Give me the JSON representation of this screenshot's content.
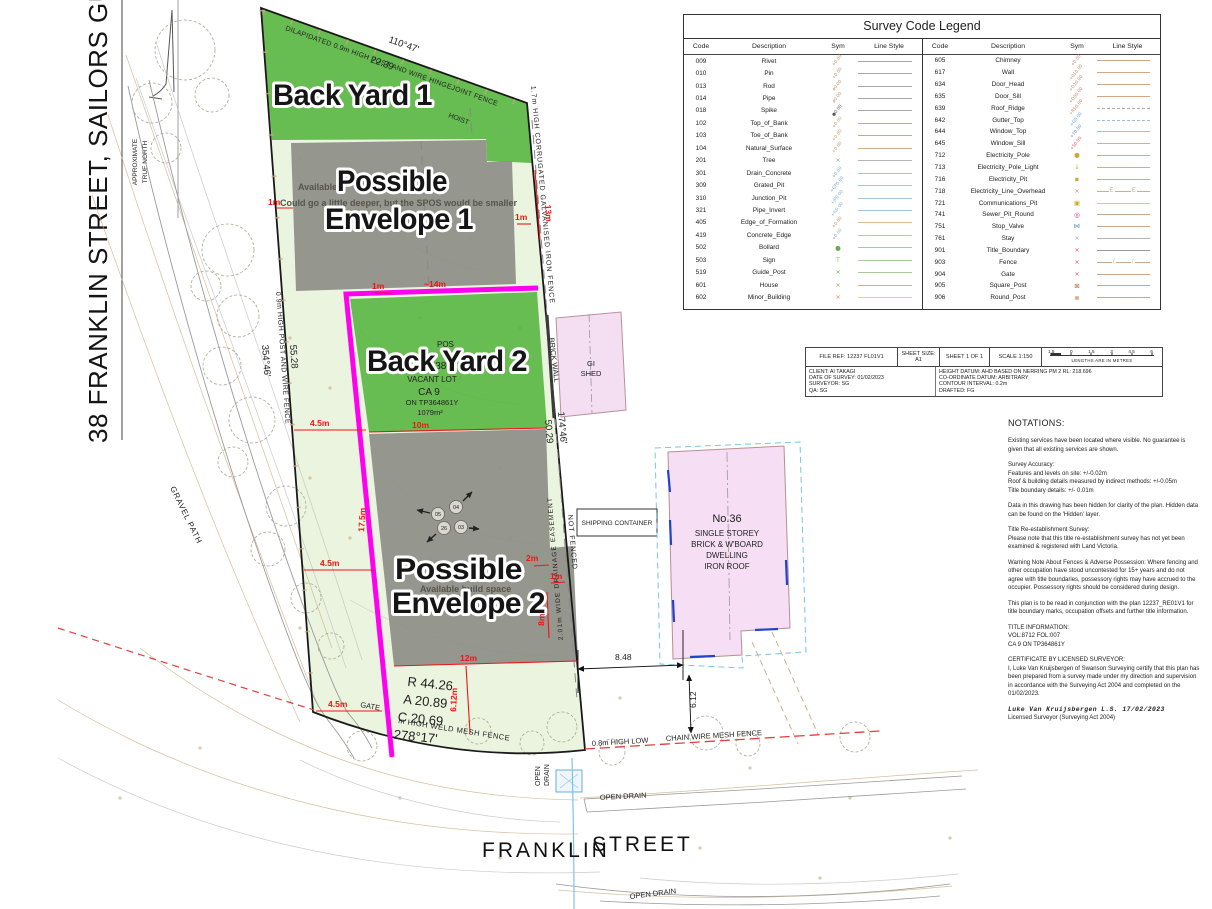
{
  "page": {
    "title_vertical": "38 FRANKLIN STREET, SAILORS GULLY, 3556",
    "north_line1": "APPROXIMATE",
    "north_line2": "TRUE NORTH"
  },
  "legend": {
    "title": "Survey Code Legend",
    "headers": [
      "Code",
      "Description",
      "Sym",
      "Line Style"
    ],
    "left": [
      {
        "c": "009",
        "d": "Rivet",
        "s": "+0.00",
        "sc": "#b89070",
        "lc": "#a8a8a8",
        "ls": "solid"
      },
      {
        "c": "010",
        "d": "Pin",
        "s": "+0.00",
        "sc": "#b89070",
        "lc": "#a8a8a8",
        "ls": "solid"
      },
      {
        "c": "013",
        "d": "Rod",
        "s": "ø0.00",
        "sc": "#b89070",
        "lc": "#a8a8a8",
        "ls": "solid"
      },
      {
        "c": "014",
        "d": "Pipe",
        "s": "ø0.00",
        "sc": "#b89070",
        "lc": "#a8a8a8",
        "ls": "solid"
      },
      {
        "c": "018",
        "d": "Spike",
        "s": "●0.00",
        "sc": "#555555",
        "lc": "#a8a8a8",
        "ls": "solid"
      },
      {
        "c": "102",
        "d": "Top_of_Bank",
        "s": "+0.00",
        "sc": "#c49a6c",
        "lc": "#c8a87c",
        "ls": "solid"
      },
      {
        "c": "103",
        "d": "Toe_of_Bank",
        "s": "+0.00",
        "sc": "#c49a6c",
        "lc": "#c8a87c",
        "ls": "solid"
      },
      {
        "c": "104",
        "d": "Natural_Surface",
        "s": "+0.00",
        "sc": "#c49a6c",
        "lc": "#d8b088",
        "ls": "solid"
      },
      {
        "c": "201",
        "d": "Tree",
        "s": "×",
        "sc": "#9aa87a",
        "lc": "#b4b4b4",
        "ls": "solid"
      },
      {
        "c": "301",
        "d": "Drain_Concrete",
        "s": "+0.00",
        "sc": "#7aa8cc",
        "lc": "#a4c4dc",
        "ls": "solid"
      },
      {
        "c": "309",
        "d": "Grated_Pit",
        "s": "+GP0.00",
        "sc": "#7aa8cc",
        "lc": "#a4c4dc",
        "ls": "solid"
      },
      {
        "c": "310",
        "d": "Junction_Pit",
        "s": "+JP0.00",
        "sc": "#7aa8cc",
        "lc": "#a4c4dc",
        "ls": "solid"
      },
      {
        "c": "321",
        "d": "Pipe_Invert",
        "s": "+IL0.00",
        "sc": "#7aa8cc",
        "lc": "#a4c4dc",
        "ls": "solid"
      },
      {
        "c": "405",
        "d": "Edge_of_Formation",
        "s": "+0.00",
        "sc": "#c89058",
        "lc": "#e0bc90",
        "ls": "solid"
      },
      {
        "c": "419",
        "d": "Concrete_Edge",
        "s": "+0.00",
        "sc": "#90a8c0",
        "lc": "#b4c4d4",
        "ls": "solid"
      },
      {
        "c": "502",
        "d": "Bollard",
        "s": "●",
        "sc": "#6aaa50",
        "lc": "#a8c8a0",
        "ls": "solid"
      },
      {
        "c": "503",
        "d": "Sign",
        "s": "⊤",
        "sc": "#6aaa50",
        "lc": "#a8c8a0",
        "ls": "solid"
      },
      {
        "c": "519",
        "d": "Guide_Post",
        "s": "×",
        "sc": "#6aaa50",
        "lc": "#a8c8a0",
        "ls": "solid"
      },
      {
        "c": "601",
        "d": "House",
        "s": "×",
        "sc": "#cc8866",
        "lc": "#d8ac94",
        "ls": "solid"
      },
      {
        "c": "602",
        "d": "Minor_Building",
        "s": "×",
        "sc": "#cc8866",
        "lc": "#e4c8a0",
        "ls": "solid"
      }
    ],
    "right": [
      {
        "c": "605",
        "d": "Chimney",
        "s": "+0.00",
        "sc": "#c08868",
        "lc": "#d0a888",
        "ls": "solid"
      },
      {
        "c": "617",
        "d": "Wall",
        "s": "+010.00",
        "sc": "#c08868",
        "lc": "#d0a888",
        "ls": "solid"
      },
      {
        "c": "634",
        "d": "Door_Head",
        "s": "+D10.00",
        "sc": "#c08868",
        "lc": "#d0a888",
        "ls": "solid"
      },
      {
        "c": "635",
        "d": "Door_Sill",
        "s": "+D50.00",
        "sc": "#c08868",
        "lc": "#d0a888",
        "ls": "solid"
      },
      {
        "c": "639",
        "d": "Roof_Ridge",
        "s": "+R50.00",
        "sc": "#c08868",
        "lc": "#a8a8a8",
        "ls": "dashed"
      },
      {
        "c": "642",
        "d": "Gutter_Top",
        "s": "+G0.00",
        "sc": "#68a0d0",
        "lc": "#9cc0dc",
        "ls": "dashed"
      },
      {
        "c": "644",
        "d": "Window_Top",
        "s": "+T0.00",
        "sc": "#5890d0",
        "lc": "#9cc0dc",
        "ls": "solid"
      },
      {
        "c": "645",
        "d": "Window_Sill",
        "s": "+S0.00",
        "sc": "#e06060",
        "lc": "#dca8a0",
        "ls": "solid"
      },
      {
        "c": "712",
        "d": "Electricity_Pole",
        "s": "●",
        "sc": "#d0a830",
        "lc": "#c8b088",
        "ls": "solid"
      },
      {
        "c": "713",
        "d": "Electricity_Pole_Light",
        "s": "↓",
        "sc": "#d0a830",
        "lc": "#c8b088",
        "ls": "solid"
      },
      {
        "c": "716",
        "d": "Electricity_Pit",
        "s": "▪",
        "sc": "#d0a830",
        "lc": "#c8b088",
        "ls": "solid"
      },
      {
        "c": "718",
        "d": "Electricity_Line_Overhead",
        "s": "×",
        "sc": "#c09060",
        "lc": "#c8b088",
        "ls": "overhead"
      },
      {
        "c": "721",
        "d": "Communications_Pit",
        "s": "▣",
        "sc": "#d0a830",
        "lc": "#e0c878",
        "ls": "solid"
      },
      {
        "c": "741",
        "d": "Sewer_Pit_Round",
        "s": "◎",
        "sc": "#e0218a",
        "lc": "#c4a890",
        "ls": "solid"
      },
      {
        "c": "751",
        "d": "Stop_Valve",
        "s": "⋈",
        "sc": "#5890d0",
        "lc": "#c4a890",
        "ls": "solid"
      },
      {
        "c": "761",
        "d": "Stay",
        "s": "×",
        "sc": "#aaaaaa",
        "lc": "#b4b4b4",
        "ls": "solid"
      },
      {
        "c": "901",
        "d": "Title_Boundary",
        "s": "×",
        "sc": "#e05050",
        "lc": "#989898",
        "ls": "solid"
      },
      {
        "c": "903",
        "d": "Fence",
        "s": "×",
        "sc": "#e05050",
        "lc": "#c4a890",
        "ls": "fence"
      },
      {
        "c": "904",
        "d": "Gate",
        "s": "×",
        "sc": "#e05050",
        "lc": "#c4a890",
        "ls": "solid"
      },
      {
        "c": "905",
        "d": "Square_Post",
        "s": "⊠",
        "sc": "#b07848",
        "lc": "#c4a890",
        "ls": "solid"
      },
      {
        "c": "906",
        "d": "Round_Post",
        "s": "⊗",
        "sc": "#b07848",
        "lc": "#c4a890",
        "ls": "solid"
      }
    ]
  },
  "title_block": {
    "file_ref": "FILE REF:  12237 FL01V1",
    "sheet_size": "SHEET SIZE:\nA1",
    "sheet": "SHEET 1 OF 1",
    "scale": "SCALE    1:150",
    "scalebar_ticks": [
      "1.5",
      "0",
      "1.5",
      "3",
      "4.5",
      "6"
    ],
    "scalebar_note": "LENGTHS ARE IN METRES",
    "client": "CLIENT: AI TAKAGI",
    "date_of_survey": "DATE OF SURVEY: 01/02/2023",
    "surveyor": "SURVEYOR: SG",
    "qa": "QA: SG",
    "height_datum": "HEIGHT DATUM: AHD BASED ON NERRING PM 2 RL: 218.696",
    "coordinate_datum": "CO-ORDINATE DATUM: ARBITRARY",
    "contour_interval": "CONTOUR INTERVAL: 0.2m",
    "drafted": "DRAFTED: FG"
  },
  "notations": {
    "heading": "NOTATIONS:",
    "paragraphs": [
      "Existing services have been located where visible. No guarantee is given that all existing services are shown.",
      "Survey Accuracy:\nFeatures and levels on site: +/-0.02m\nRoof & building details measured by indirect methods: +/-0.05m\nTitle boundary details: +/- 0.01m",
      "Data in this drawing has been hidden for clarity of the plan. Hidden data can be found on the 'Hidden' layer.",
      "Title Re-establishment Survey:\nPlease note that this title re-establishment survey has not yet been examined & registered with Land Victoria.",
      "Warning Note About Fences & Adverse Possession: Where fencing and other occupation have stood uncontested for 15+ years and do not agree with title boundaries, possessory rights may have accrued to the occupier. Possessory rights should be considered during design.",
      "This plan is to be read in conjunction with the plan 12237_RE01V1 for title boundary marks, occupation offsets and further title information.",
      "TITLE INFORMATION:\nVOL:8712 FOL:007\nCA 9 ON TP364861Y",
      "CERTIFICATE BY LICENSED SURVEYOR:\nI, Luke Van Kruijsbergen  of Swanson Surveying certify that this plan has been prepared from a survey made under my direction and supervision in accordance with the Surveying Act 2004 and completed on the 01/02/2023."
    ],
    "signature": "Luke Van Kruijsbergen   L.S.  17/02/2023",
    "signature_sub": "Licensed Surveyor (Surveying Act 2004)"
  },
  "plan": {
    "labels": {
      "back_yard_1": "Back Yard 1",
      "back_yard_2": "Back Yard 2",
      "possible": "Possible",
      "envelope_1": "Envelope 1",
      "envelope_2": "Envelope 2",
      "available": "Available",
      "spos_note": "Could go a little deeper, but the SPOS would be smaller",
      "available_build": "Available build space",
      "pos": "POS",
      "no38": "No.38",
      "vacant_lot": "VACANT LOT",
      "ca9": "CA 9",
      "tp": "ON TP364861Y",
      "area": "1079m²",
      "fence_top": "DILAPIDATED 0.9m HIGH POST AND WIRE HINGEJOINT FENCE",
      "bearing_top": "110°47'",
      "dist_top": "22.39",
      "hoist": "HOIST",
      "fence_right": "1.7m HIGH CORRUGATED GALVANISED IRON FENCE",
      "fence_left": "0.9m HIGH POST AND WIRE FENCE",
      "bearing_left": "354°46'",
      "dist_left": "55.28",
      "gravel_path": "GRAVEL PATH",
      "bearing_right": "174°46'",
      "dist_right": "50.29",
      "brick_wall": "BRICK WALL",
      "easement": "2.01m WIDE DRAINAGE EASEMENT",
      "not_fenced": "NOT FENCED",
      "gi": "GI",
      "shed": "SHED",
      "shipping_container": "SHIPPING CONTAINER",
      "no36": "No.36",
      "no36_2": "SINGLE STOREY",
      "no36_3": "BRICK & W'BOARD",
      "no36_4": "DWELLING",
      "no36_5": "IRON ROOF",
      "gate": "GATE",
      "weld_fence": "m HIGH WELD MESH FENCE",
      "chain_fence_1": "0.8m HIGH LOW",
      "chain_fence_2": "CHAIN WIRE MESH FENCE",
      "open": "OPEN",
      "drain": "DRAIN",
      "open_drain": "OPEN DRAIN",
      "franklin": "FRANKLIN",
      "street": "STREET",
      "arc_r": "R 44.26",
      "arc_a": "A 20.89",
      "arc_c": "C 20.69",
      "arc_brg": "278°17'",
      "dim_848": "8.48",
      "dim_612": "6.12",
      "d1m": "1m",
      "d2m": "2m",
      "d45m": "4.5m",
      "d8m": "8m",
      "d10m": "10m",
      "d12m": "12m",
      "d13m": "13m",
      "d14m": "~14m",
      "d175m": "17.5m",
      "d612m": "6.12m",
      "t03": "03",
      "t04": "04",
      "t05": "05",
      "t26": "26"
    },
    "colors": {
      "yard_green": "#54b43f",
      "envelope_gray": "#8e8e86",
      "magenta": "#ff00f0",
      "lot_fill": "#ebf4df",
      "building_pink": "#f6def4",
      "dim_red": "#f01414"
    }
  }
}
